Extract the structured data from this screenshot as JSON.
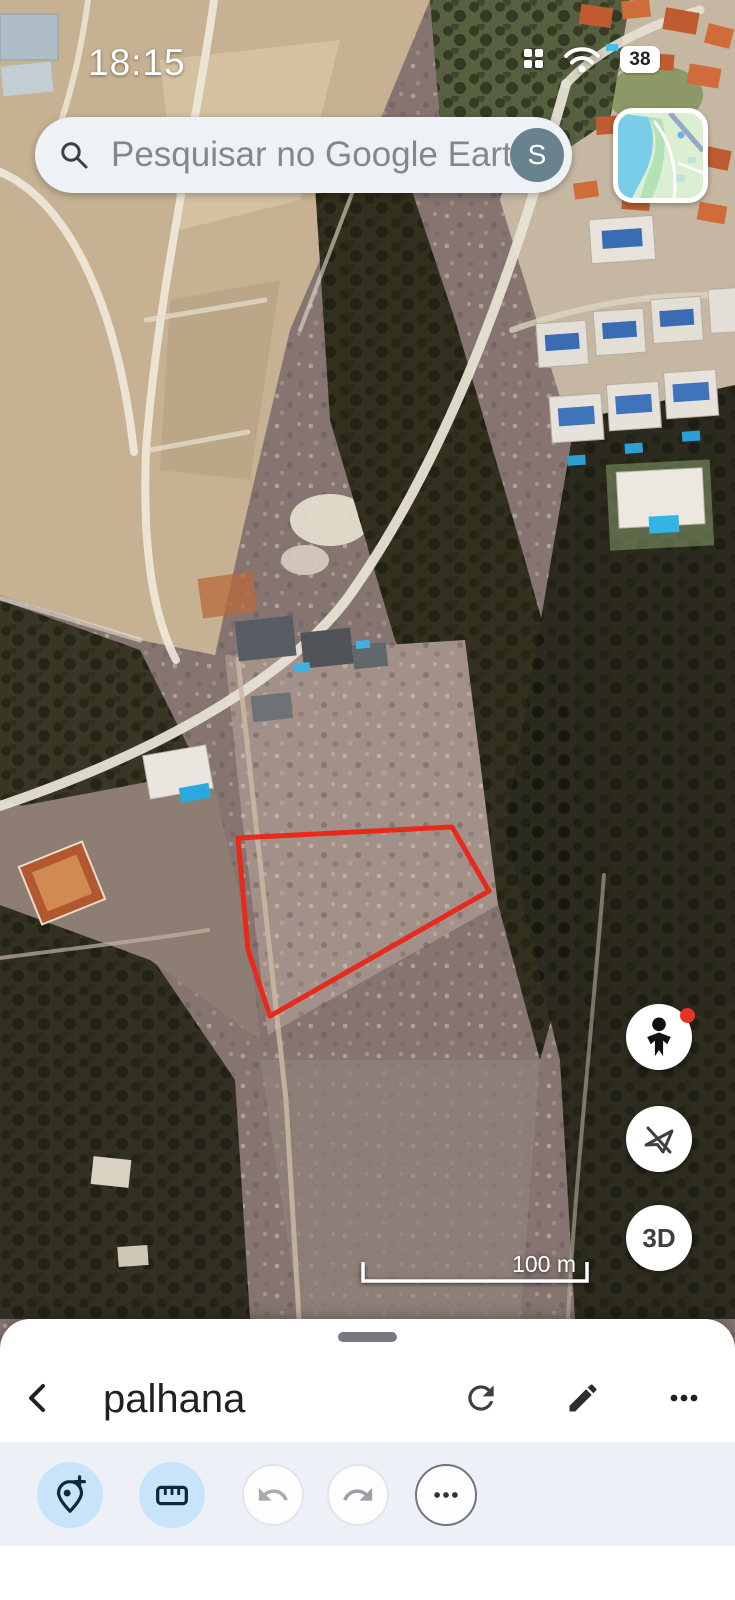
{
  "status_bar": {
    "time": "18:15",
    "battery_percent": "38"
  },
  "search_bar": {
    "placeholder": "Pesquisar no Google Earth",
    "account_letter": "S"
  },
  "map": {
    "scale_label": "100 m",
    "three_d_label": "3D",
    "red_polygon": {
      "points": "238,838 452,827 489,891 270,1016 248,950",
      "stroke_color": "#e8291c"
    },
    "controls": [
      "street-view-pegman",
      "fly-tour-disabled",
      "3d-toggle"
    ]
  },
  "bottom_sheet": {
    "title": "palhana",
    "header_actions": [
      "back",
      "refresh",
      "edit",
      "more"
    ],
    "toolbar_actions": [
      "add-placemark",
      "measure",
      "undo",
      "redo",
      "more"
    ]
  },
  "colors": {
    "polygon_red": "#e8291c",
    "toolbar_active_bg": "#c8e4fa",
    "toolbar_icon_navy": "#0b2a41",
    "toolbar_band_bg": "#edf1f7",
    "avatar_bg": "#68838e",
    "notification_dot": "#e93223"
  }
}
